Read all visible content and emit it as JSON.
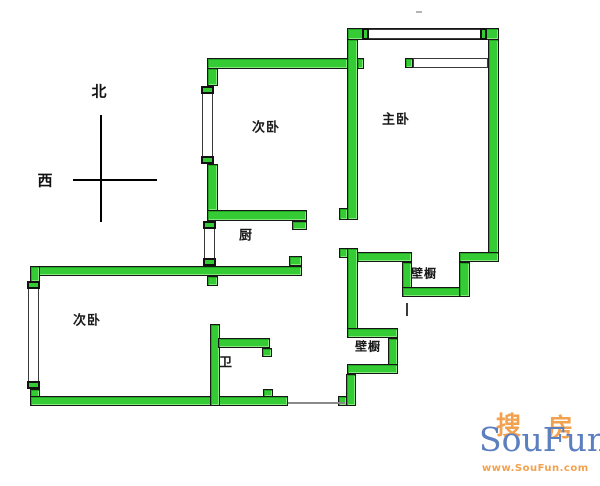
{
  "compass": {
    "north_label": "北",
    "west_label": "西"
  },
  "rooms": [
    {
      "id": "bedroom-secondary-upper",
      "label": "次卧",
      "cx": 266,
      "cy": 126,
      "size": 13
    },
    {
      "id": "bedroom-master",
      "label": "主卧",
      "cx": 396,
      "cy": 118,
      "size": 13
    },
    {
      "id": "kitchen",
      "label": "厨",
      "cx": 246,
      "cy": 234,
      "size": 13
    },
    {
      "id": "bedroom-secondary-lower",
      "label": "次卧",
      "cx": 87,
      "cy": 319,
      "size": 13
    },
    {
      "id": "bathroom",
      "label": "卫",
      "cx": 226,
      "cy": 361,
      "size": 13
    },
    {
      "id": "closet-upper",
      "label": "壁橱",
      "cx": 424,
      "cy": 273,
      "size": 12
    },
    {
      "id": "closet-lower",
      "label": "壁橱",
      "cx": 368,
      "cy": 346,
      "size": 12
    }
  ],
  "watermark": {
    "brand": "SouFun",
    "cjk_left": "搜",
    "cjk_right": "房",
    "url": "www.SouFun.com",
    "brand_color": "#5c7fc0",
    "accent_color": "#f2a24f"
  },
  "colors": {
    "wall_fill": "#35cb35",
    "wall_outline": "#161616",
    "line_color": "#000000",
    "background": "#ffffff"
  },
  "plan": {
    "walls": [
      [
        "master-north-wall",
        347,
        28,
        152,
        12
      ],
      [
        "master-west-wall",
        347,
        39,
        11,
        181
      ],
      [
        "master-west-wall-foot",
        339,
        208,
        9,
        12
      ],
      [
        "master-east-wall",
        488,
        39,
        11,
        223
      ],
      [
        "master-shelf-cap",
        405,
        58,
        8,
        10
      ],
      [
        "bedroom2-north-wall",
        207,
        58,
        141,
        11
      ],
      [
        "bedroom2-north-wall-stub",
        357,
        58,
        7,
        11
      ],
      [
        "bedroom2-west-wall-upper",
        207,
        68,
        11,
        18
      ],
      [
        "bedroom2-west-wall-lower",
        207,
        164,
        11,
        47
      ],
      [
        "kitchen-north-wall",
        207,
        210,
        100,
        11
      ],
      [
        "kitchen-north-wall-tab",
        292,
        221,
        15,
        9
      ],
      [
        "middle-south-wall",
        30,
        266,
        272,
        10
      ],
      [
        "middle-south-wall-tab",
        289,
        256,
        13,
        10
      ],
      [
        "middle-south-wall-stub",
        207,
        276,
        11,
        10
      ],
      [
        "bedroom3-west-wall-upper",
        30,
        266,
        10,
        16
      ],
      [
        "bedroom3-west-wall-lower",
        30,
        389,
        10,
        17
      ],
      [
        "bedroom3-south-wall",
        30,
        396,
        258,
        10
      ],
      [
        "bedroom3-south-wall-tab",
        263,
        389,
        10,
        8
      ],
      [
        "bathroom-west-wall",
        210,
        324,
        10,
        82
      ],
      [
        "bathroom-north-wall",
        218,
        338,
        52,
        10
      ],
      [
        "bathroom-north-wall-tab",
        262,
        348,
        10,
        9
      ],
      [
        "hall-east-wall-upper",
        347,
        248,
        11,
        89
      ],
      [
        "hall-east-wall-upper-tab",
        339,
        248,
        9,
        10
      ],
      [
        "closet-upper-west-wall",
        357,
        252,
        55,
        10
      ],
      [
        "closet-upper-left-bar",
        402,
        262,
        10,
        35
      ],
      [
        "closet-upper-south-bar",
        402,
        287,
        68,
        10
      ],
      [
        "closet-upper-right-bar",
        459,
        262,
        11,
        35
      ],
      [
        "closet-upper-east-wall",
        459,
        252,
        40,
        10
      ],
      [
        "closet-lower-north-bar",
        347,
        328,
        51,
        10
      ],
      [
        "closet-lower-east-bar",
        388,
        338,
        10,
        36
      ],
      [
        "closet-lower-south-bar",
        347,
        364,
        51,
        10
      ],
      [
        "hall-east-wall-lower",
        346,
        374,
        10,
        32
      ],
      [
        "hall-east-wall-lower-foot",
        338,
        396,
        9,
        10
      ]
    ],
    "windows": [
      [
        "master-north-window",
        362,
        29,
        125,
        10,
        true
      ],
      [
        "master-inner-shelf",
        413,
        58,
        75,
        10,
        false
      ],
      [
        "bedroom2-west-window",
        202,
        86,
        11,
        78,
        true
      ],
      [
        "kitchen-west-window",
        204,
        221,
        11,
        45,
        true
      ],
      [
        "bedroom3-west-window",
        28,
        281,
        11,
        108,
        true
      ]
    ],
    "lines": [
      [
        "threshold-line",
        288,
        402,
        57,
        2,
        "#8a8a8a"
      ],
      [
        "closet-door-mark",
        406,
        303,
        2,
        13,
        "#3a3a3a"
      ],
      [
        "stray-mark",
        416,
        11,
        6,
        2,
        "#b5b5b5"
      ]
    ]
  }
}
